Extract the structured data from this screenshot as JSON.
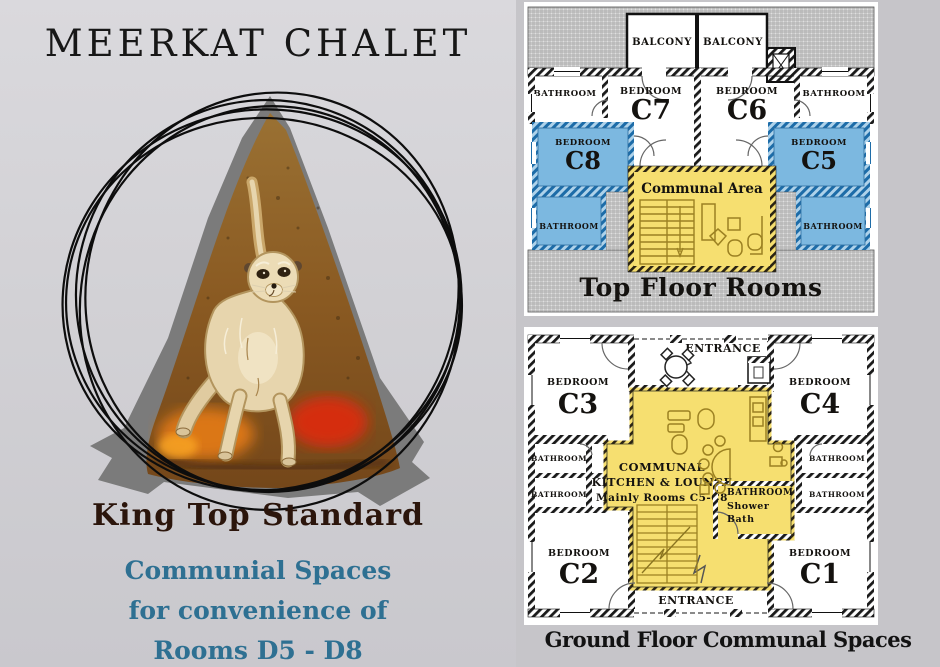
{
  "left_panel": {
    "title": "MEERKAT CHALET",
    "heading": "King Top Standard",
    "subheading_lines": [
      "Communial Spaces",
      "for convenience of",
      "Rooms D5 - D8"
    ]
  },
  "top_floor": {
    "caption": "Top Floor Rooms",
    "labels": {
      "balcony_left": "BALCONY",
      "balcony_right": "BALCONY",
      "bathroom_top_left": "BATHROOM",
      "bathroom_top_right": "BATHROOM",
      "bedroom_c7_type": "BEDROOM",
      "bedroom_c7_code": "C7",
      "bedroom_c6_type": "BEDROOM",
      "bedroom_c6_code": "C6",
      "bedroom_c8_type": "BEDROOM",
      "bedroom_c8_code": "C8",
      "bedroom_c5_type": "BEDROOM",
      "bedroom_c5_code": "C5",
      "bathroom_mid_left": "BATHROOM",
      "bathroom_mid_right": "BATHROOM",
      "communal_area": "Communal Area"
    }
  },
  "ground_floor": {
    "caption": "Ground Floor Communal Spaces",
    "labels": {
      "entrance_top": "ENTRANCE",
      "entrance_bottom": "ENTRANCE",
      "bedroom_c3_type": "BEDROOM",
      "bedroom_c3_code": "C3",
      "bedroom_c4_type": "BEDROOM",
      "bedroom_c4_code": "C4",
      "bedroom_c2_type": "BEDROOM",
      "bedroom_c2_code": "C2",
      "bedroom_c1_type": "BEDROOM",
      "bedroom_c1_code": "C1",
      "bathroom_left_1": "BATHROOM",
      "bathroom_left_2": "BATHROOM",
      "bathroom_right_1": "BATHROOM",
      "bathroom_right_2": "BATHROOM",
      "communal_line1": "COMMUNAL",
      "communal_line2": "KITCHEN & LOUNGE",
      "communal_line3": "Mainly Rooms C5-C8",
      "shower_bathroom": "BATHROOM",
      "shower_line1": "Shower",
      "shower_line2": "Bath"
    }
  },
  "colors": {
    "room_highlight_blue": "#7cb8e0",
    "communal_yellow": "#f6df70",
    "accent_teal": "#2e7092",
    "heading_brown": "#2b150b"
  }
}
